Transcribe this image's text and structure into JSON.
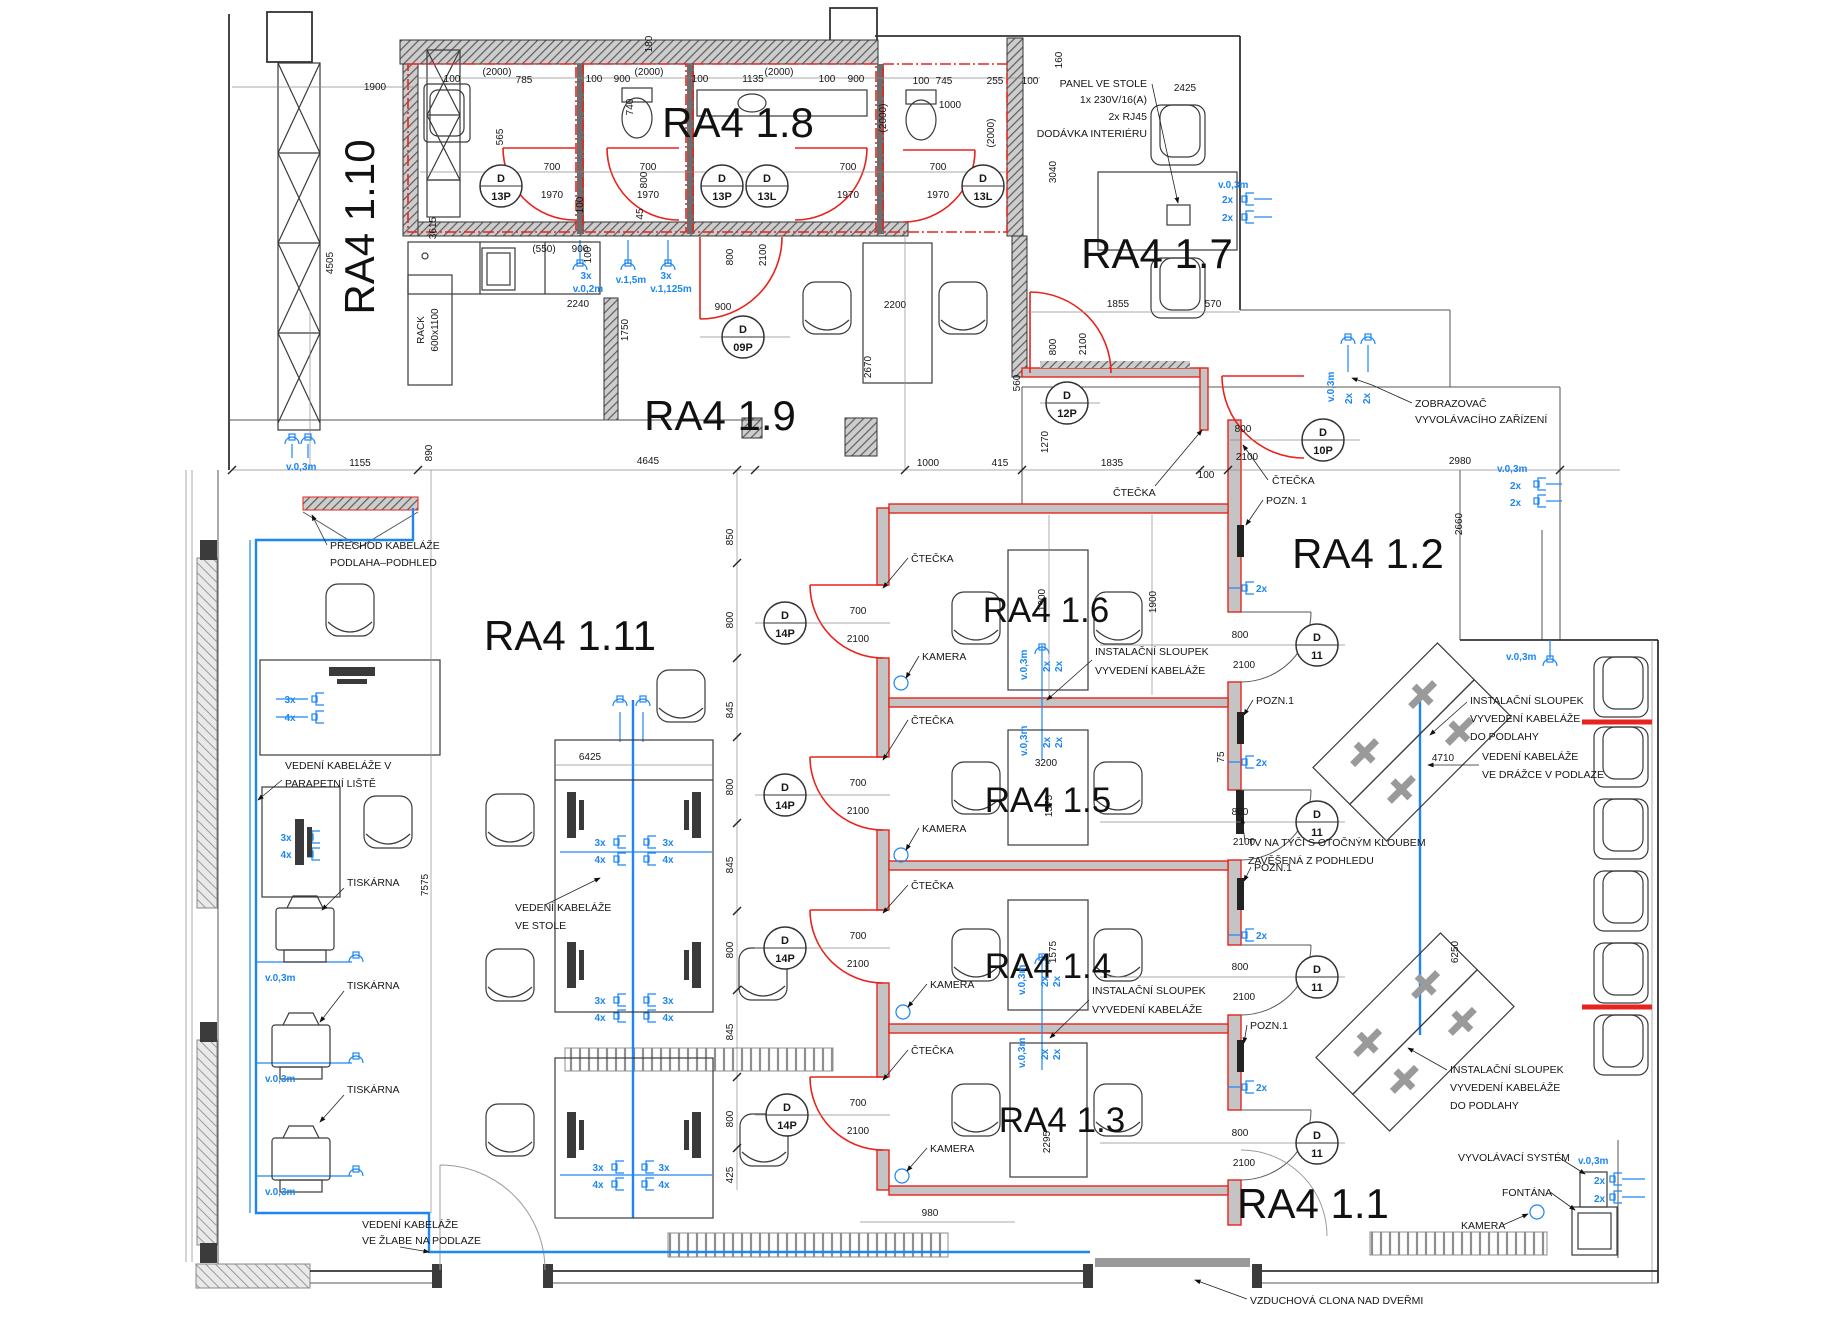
{
  "rooms": {
    "r1": "RA4 1.1",
    "r2": "RA4 1.2",
    "r3": "RA4 1.3",
    "r4": "RA4 1.4",
    "r5": "RA4 1.5",
    "r6": "RA4 1.6",
    "r7": "RA4 1.7",
    "r8": "RA4 1.8",
    "r9": "RA4 1.9",
    "r10": "RA4 1.10",
    "r11": "RA4 1.11"
  },
  "tag": {
    "D": "D",
    "13P": "13P",
    "13L": "13L",
    "09P": "09P",
    "12P": "12P",
    "10P": "10P",
    "14P": "14P",
    "11": "11"
  },
  "dims": {
    "45": "45",
    "75": "75",
    "100": "100",
    "160": "160",
    "180": "180",
    "255": "255",
    "415": "415",
    "425": "425",
    "(550)": "(550)",
    "560": "560",
    "565": "565",
    "570": "570",
    "700": "700",
    "740": "740",
    "745": "745",
    "785": "785",
    "800": "800",
    "845": "845",
    "850": "850",
    "890": "890",
    "900": "900",
    "980": "980",
    "1000": "1000",
    "1135": "1135",
    "1155": "1155",
    "1270": "1270",
    "1575": "1575",
    "1750": "1750",
    "1835": "1835",
    "1855": "1855",
    "1900": "1900",
    "1970": "1970",
    "(2000)": "(2000)",
    "2100": "2100",
    "2200": "2200",
    "2240": "2240",
    "2295": "2295",
    "2425": "2425",
    "2660": "2660",
    "2670": "2670",
    "2980": "2980",
    "3040": "3040",
    "3200": "3200",
    "3615": "3615",
    "4505": "4505",
    "4645": "4645",
    "4710": "4710",
    "6250": "6250",
    "6425": "6425",
    "7575": "7575"
  },
  "labels": {
    "ctecka": "ČTEČKA",
    "kamera": "KAMERA",
    "tiskarna": "TISKÁRNA",
    "pozn_sp": "POZN. 1",
    "pozn": "POZN.1",
    "panel": [
      "PANEL VE STOLE",
      "1x 230V/16(A)",
      "2x RJ45",
      "DODÁVKA INTERIÉRU"
    ],
    "zobrazovac": [
      "ZOBRAZOVAČ",
      "VYVOLÁVACÍHO ZAŘÍZENÍ"
    ],
    "sloupek": [
      "INSTALAČNÍ SLOUPEK",
      "VYVEDENÍ KABELÁŽE"
    ],
    "sloupek_podlahy": [
      "INSTALAČNÍ SLOUPEK",
      "VYVEDENÍ KABELÁŽE",
      "DO PODLAHY"
    ],
    "tv": [
      "TV NA TYČI S OTOČNÝM KLOUBEM",
      "ZAVĚŠENÁ Z PODHLEDU"
    ],
    "drazka": [
      "VEDENÍ KABELÁŽE",
      "VE DRÁŽCE V PODLAZE"
    ],
    "parapet": [
      "VEDENÍ KABELÁŽE V",
      "PARAPETNÍ LIŠTĚ"
    ],
    "stole": [
      "VEDENÍ KABELÁŽE",
      "VE STOLE"
    ],
    "zlab": [
      "VEDENÍ KABELÁŽE",
      "VE ŽLABE NA PODLAZE"
    ],
    "prechod": [
      "PŘECHOD KABELÁŽE",
      "PODLAHA–PODHLED"
    ],
    "vyvolavaci": "VYVOLÁVACÍ SYSTÉM",
    "fontana": "FONTÁNA",
    "vzduchova": "VZDUCHOVÁ CLONA NAD DVEŘMI",
    "rack": [
      "RACK",
      "600x1100"
    ]
  },
  "blue": {
    "v03": "v.0,3m",
    "v02": "v.0,2m",
    "v15": "v.1,5m",
    "v1125": "v.1,125m",
    "x2": "2x",
    "x3": "3x",
    "x4": "4x"
  },
  "colors": {
    "red": "#e8231d",
    "blue": "#1d86f2",
    "wall": "#3b3b3b",
    "line": "#555555",
    "bg": "#ffffff"
  }
}
